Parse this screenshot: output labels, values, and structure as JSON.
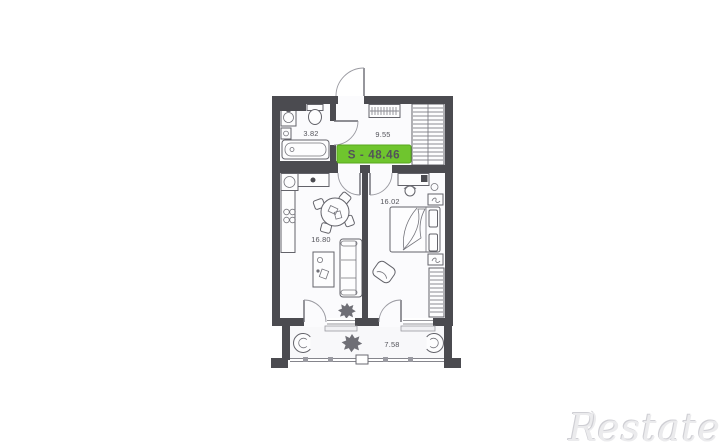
{
  "floor_plan": {
    "total_area_badge": "S - 48.46",
    "badge_color": "#6fc52e",
    "wall_color": "#4b4b50",
    "rooms": {
      "bathroom": {
        "area": "3.82"
      },
      "hallway": {
        "area": "9.55"
      },
      "living_kitchen": {
        "area": "16.80"
      },
      "bedroom": {
        "area": "16.02"
      },
      "balcony": {
        "area": "7.58"
      }
    }
  },
  "watermark": {
    "prefix": "R",
    "mark": ")",
    "suffix": "estate"
  }
}
